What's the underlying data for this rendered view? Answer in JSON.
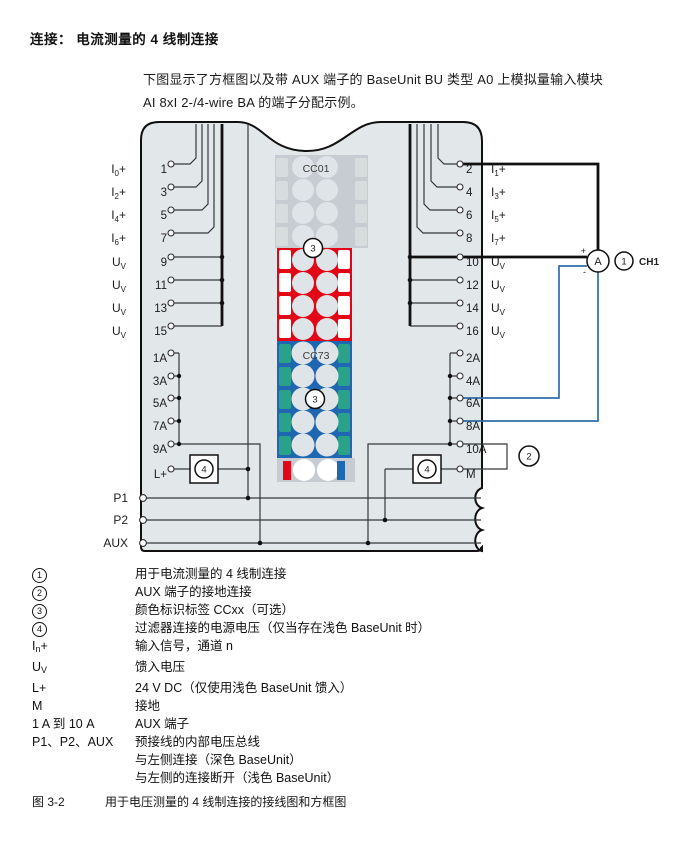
{
  "page": {
    "title": "连接： 电流测量的 4 线制连接",
    "intro_line1": "下图显示了方框图以及带 AUX 端子的 BaseUnit BU 类型 A0 上模拟量输入模块",
    "intro_line2": "AI 8xI 2-/4-wire BA 的端子分配示例。"
  },
  "diagram": {
    "left_rows": [
      {
        "main": "I",
        "sub": "0",
        "suf": "+",
        "num": "1"
      },
      {
        "main": "I",
        "sub": "2",
        "suf": "+",
        "num": "3"
      },
      {
        "main": "I",
        "sub": "4",
        "suf": "+",
        "num": "5"
      },
      {
        "main": "I",
        "sub": "6",
        "suf": "+",
        "num": "7"
      },
      {
        "main": "U",
        "sub": "V",
        "suf": "",
        "num": "9"
      },
      {
        "main": "U",
        "sub": "V",
        "suf": "",
        "num": "11"
      },
      {
        "main": "U",
        "sub": "V",
        "suf": "",
        "num": "13"
      },
      {
        "main": "U",
        "sub": "V",
        "suf": "",
        "num": "15"
      }
    ],
    "right_rows": [
      {
        "main": "I",
        "sub": "1",
        "suf": "+",
        "num": "2"
      },
      {
        "main": "I",
        "sub": "3",
        "suf": "+",
        "num": "4"
      },
      {
        "main": "I",
        "sub": "5",
        "suf": "+",
        "num": "6"
      },
      {
        "main": "I",
        "sub": "7",
        "suf": "+",
        "num": "8"
      },
      {
        "main": "U",
        "sub": "V",
        "suf": "",
        "num": "10"
      },
      {
        "main": "U",
        "sub": "V",
        "suf": "",
        "num": "12"
      },
      {
        "main": "U",
        "sub": "V",
        "suf": "",
        "num": "14"
      },
      {
        "main": "U",
        "sub": "V",
        "suf": "",
        "num": "16"
      }
    ],
    "aux_left": [
      "1A",
      "3A",
      "5A",
      "7A",
      "9A",
      "L+"
    ],
    "aux_right": [
      "2A",
      "4A",
      "6A",
      "8A",
      "10A",
      "M"
    ],
    "bus_labels": [
      "P1",
      "P2",
      "AUX"
    ],
    "cc_top": "CC01",
    "cc_bottom": "CC73",
    "badge_1": "1",
    "badge_2": "2",
    "badge_3": "3",
    "badge_4": "4",
    "ammeter": "A",
    "plus": "+",
    "minus": "-",
    "channel": "CH1",
    "colors": {
      "body": "#e2e7ea",
      "label_red": "#e30617",
      "label_blue": "#1f67b0",
      "tab_green": "#2aa189",
      "block_gray": "#c6ccd2",
      "tab_gray": "#d7dcdf",
      "wire_blue": "#2e6ea9"
    }
  },
  "legend": {
    "rows": [
      {
        "circled": "1",
        "desc": [
          "用于电流测量的 4 线制连接"
        ]
      },
      {
        "circled": "2",
        "desc": [
          "AUX 端子的接地连接"
        ]
      },
      {
        "circled": "3",
        "desc": [
          "颜色标识标签 CCxx（可选）"
        ]
      },
      {
        "circled": "4",
        "desc": [
          "过滤器连接的电源电压（仅当存在浅色 BaseUnit 时）"
        ]
      },
      {
        "parts": [
          {
            "t": "I"
          },
          {
            "t": "n",
            "sub": true
          },
          {
            "t": "+"
          }
        ],
        "desc": [
          "输入信号，通道 n"
        ]
      },
      {
        "parts": [
          {
            "t": "U"
          },
          {
            "t": "V",
            "sub": true
          }
        ],
        "desc": [
          "馈入电压"
        ]
      },
      {
        "parts": [
          {
            "t": "L+"
          }
        ],
        "desc": [
          "24 V DC（仅使用浅色 BaseUnit 馈入）"
        ]
      },
      {
        "parts": [
          {
            "t": "M"
          }
        ],
        "desc": [
          "接地"
        ]
      },
      {
        "parts": [
          {
            "t": "1 A 到 10 A"
          }
        ],
        "desc": [
          "AUX 端子"
        ]
      },
      {
        "parts": [
          {
            "t": "P1、P2、AUX"
          }
        ],
        "desc": [
          "预接线的内部电压总线",
          "与左侧连接（深色 BaseUnit）",
          "与左侧的连接断开（浅色 BaseUnit）"
        ]
      }
    ]
  },
  "caption": {
    "fig": "图 3-2",
    "text": "用于电压测量的 4 线制连接的接线图和方框图"
  }
}
